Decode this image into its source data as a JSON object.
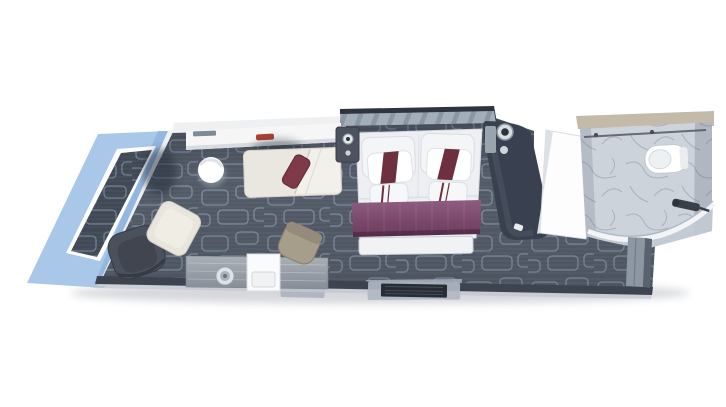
{
  "scene": {
    "kind": "top-down 3D rendered cruise-ship stateroom floor plan",
    "text_labels": []
  },
  "colors": {
    "background": "#ffffff",
    "balcony_blue": "#a9c7e8",
    "balcony_blue_edge": "#8db3dd",
    "carpet_dark": "#59616e",
    "carpet_line": "#9fb0c4",
    "deck_dark": "#414957",
    "wall_white": "#eef0f2",
    "wall_dark": "#3d4450",
    "wall_stripe": "#b9c3cf",
    "headboard_dark": "#2f3540",
    "bed_duvet": "#edeff2",
    "bed_runner_plum": "#7c476b",
    "bed_runner_plum_light": "#8e5c7f",
    "pillow_stripe_maroon": "#6e2f3f",
    "cushion_maroon": "#7e3a48",
    "chaise_cream": "#e9e7e0",
    "armchair_gray": "#4b515c",
    "lounge_chair_cream": "#e8e5dc",
    "desk_chair_tan": "#a79d8b",
    "desk_wood": "#9aa1a9",
    "bathroom_marble": "#ccd3db",
    "bathroom_wall_beige": "#c3baa9",
    "fixture_white": "#fafbfc",
    "accent_red": "#b04034",
    "wardrobe_dark": "#394050",
    "closet_panel": "#8d97a3",
    "mat_dark": "#272d37",
    "threshold_light": "#c7ccd4"
  },
  "rooms": [
    {
      "name": "balcony"
    },
    {
      "name": "living-area"
    },
    {
      "name": "sleeping-area"
    },
    {
      "name": "entry-hall"
    },
    {
      "name": "bathroom"
    }
  ],
  "objects": [
    "balcony-deck",
    "chaise-lounge",
    "accent-cushion",
    "coffee-table",
    "armchair",
    "lounge-chair",
    "console-shelf",
    "desk",
    "desk-chair",
    "minibar-cabinet",
    "ice-bucket",
    "double-bed",
    "pillows",
    "accent-pillows",
    "bed-runner",
    "foot-bench",
    "nightstand-left",
    "nightstand-right",
    "reading-lamp",
    "wardrobe-column",
    "entry-door",
    "entry-mat",
    "hall-closet",
    "toilet",
    "shower-enclosure",
    "shower-fixture"
  ]
}
